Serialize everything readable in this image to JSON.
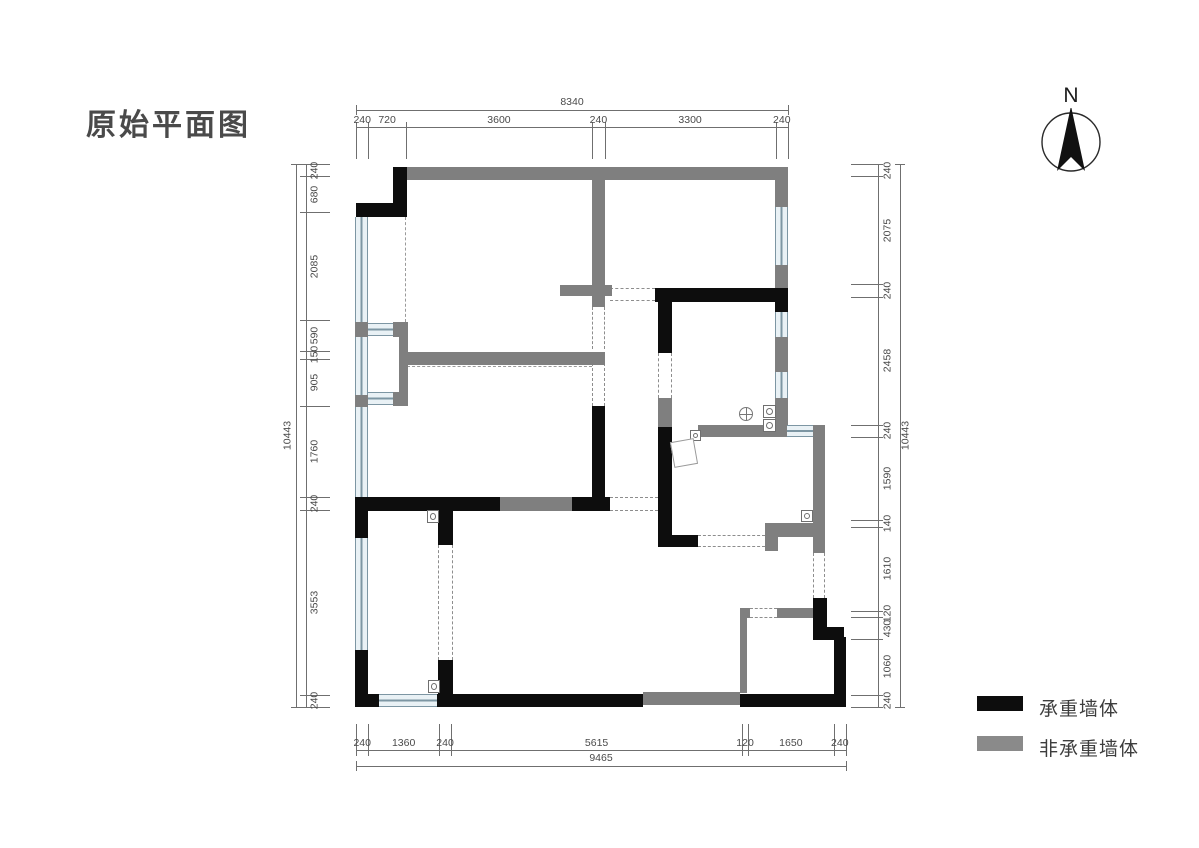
{
  "title": "原始平面图",
  "north": {
    "label": "N"
  },
  "legend": [
    {
      "label": "承重墙体",
      "color": "#0d0d0d"
    },
    {
      "label": "非承重墙体",
      "color": "#8a8a8a"
    }
  ],
  "dimensions": {
    "top": {
      "overall": "8340",
      "segments": [
        "240",
        "720",
        "3600",
        "240",
        "3300",
        "240"
      ]
    },
    "bottom": {
      "overall": "9465",
      "segments": [
        "240",
        "1360",
        "240",
        "5615",
        "120",
        "1650",
        "240"
      ]
    },
    "left": {
      "overall": "10443",
      "segments": [
        "240",
        "680",
        "2085",
        "590",
        "150",
        "905",
        "1760",
        "240",
        "3553",
        "240"
      ]
    },
    "right": {
      "overall": "10443",
      "segments": [
        "240",
        "2075",
        "240",
        "2458",
        "240",
        "1590",
        "140",
        "1610",
        "120",
        "430",
        "1060",
        "240"
      ]
    }
  },
  "plan": {
    "walls_black": [
      [
        393,
        167,
        14,
        50
      ],
      [
        356,
        203,
        51,
        14
      ],
      [
        355,
        497,
        13,
        41
      ],
      [
        355,
        650,
        13,
        57
      ],
      [
        356,
        694,
        23,
        13
      ],
      [
        437,
        694,
        206,
        13
      ],
      [
        740,
        694,
        106,
        13
      ],
      [
        438,
        500,
        15,
        45
      ],
      [
        438,
        660,
        15,
        47
      ],
      [
        356,
        497,
        144,
        14
      ],
      [
        572,
        497,
        38,
        14
      ],
      [
        592,
        406,
        13,
        91
      ],
      [
        655,
        288,
        133,
        14
      ],
      [
        658,
        301,
        14,
        52
      ],
      [
        658,
        427,
        14,
        120
      ],
      [
        658,
        535,
        40,
        12
      ],
      [
        775,
        288,
        13,
        24
      ],
      [
        813,
        598,
        14,
        33
      ],
      [
        813,
        627,
        31,
        13
      ],
      [
        834,
        637,
        12,
        70
      ]
    ],
    "walls_gray": [
      [
        407,
        167,
        368,
        13
      ],
      [
        592,
        180,
        13,
        127
      ],
      [
        560,
        285,
        52,
        11
      ],
      [
        775,
        167,
        13,
        121
      ],
      [
        775,
        337,
        13,
        35
      ],
      [
        775,
        398,
        13,
        39
      ],
      [
        403,
        352,
        202,
        13
      ],
      [
        698,
        425,
        89,
        12
      ],
      [
        813,
        425,
        12,
        128
      ],
      [
        765,
        523,
        48,
        14
      ],
      [
        765,
        537,
        13,
        14
      ],
      [
        500,
        497,
        72,
        14
      ],
      [
        740,
        608,
        10,
        10
      ],
      [
        777,
        608,
        36,
        10
      ],
      [
        740,
        618,
        7,
        75
      ],
      [
        643,
        692,
        97,
        13
      ],
      [
        355,
        322,
        13,
        15
      ],
      [
        355,
        395,
        13,
        12
      ],
      [
        393,
        322,
        15,
        15
      ],
      [
        399,
        337,
        9,
        55
      ],
      [
        393,
        392,
        15,
        14
      ],
      [
        658,
        398,
        14,
        29
      ]
    ],
    "windows_v": [
      [
        355,
        217,
        13,
        105
      ],
      [
        355,
        337,
        13,
        58
      ],
      [
        355,
        407,
        13,
        90
      ],
      [
        355,
        537,
        13,
        113
      ],
      [
        775,
        207,
        13,
        58
      ],
      [
        775,
        312,
        13,
        25
      ],
      [
        775,
        372,
        13,
        26
      ]
    ],
    "windows_h": [
      [
        368,
        323,
        25,
        13
      ],
      [
        368,
        392,
        25,
        13
      ],
      [
        378,
        694,
        59,
        13
      ],
      [
        787,
        425,
        26,
        12
      ]
    ],
    "openings_v": [
      [
        592,
        307,
        13,
        42
      ],
      [
        592,
        363,
        13,
        43
      ],
      [
        658,
        353,
        14,
        45
      ],
      [
        438,
        545,
        15,
        115
      ],
      [
        813,
        553,
        12,
        45
      ]
    ],
    "openings_h": [
      [
        610,
        288,
        45,
        13
      ],
      [
        610,
        497,
        48,
        14
      ],
      [
        698,
        535,
        67,
        12
      ],
      [
        750,
        608,
        27,
        10
      ]
    ],
    "dashed_v": [
      [
        405,
        217,
        2,
        105
      ]
    ],
    "dashed_h": [
      [
        407,
        366,
        185,
        2
      ]
    ],
    "pipes": [
      [
        763,
        405,
        13,
        13
      ],
      [
        763,
        419,
        13,
        13
      ],
      [
        801,
        510,
        12,
        12
      ],
      [
        427,
        510,
        12,
        13
      ],
      [
        428,
        680,
        12,
        13
      ],
      [
        690,
        430,
        11,
        11
      ]
    ],
    "drains": [
      [
        739,
        407,
        14,
        14
      ]
    ],
    "furniture": [
      [
        672,
        440,
        24,
        26
      ]
    ]
  }
}
